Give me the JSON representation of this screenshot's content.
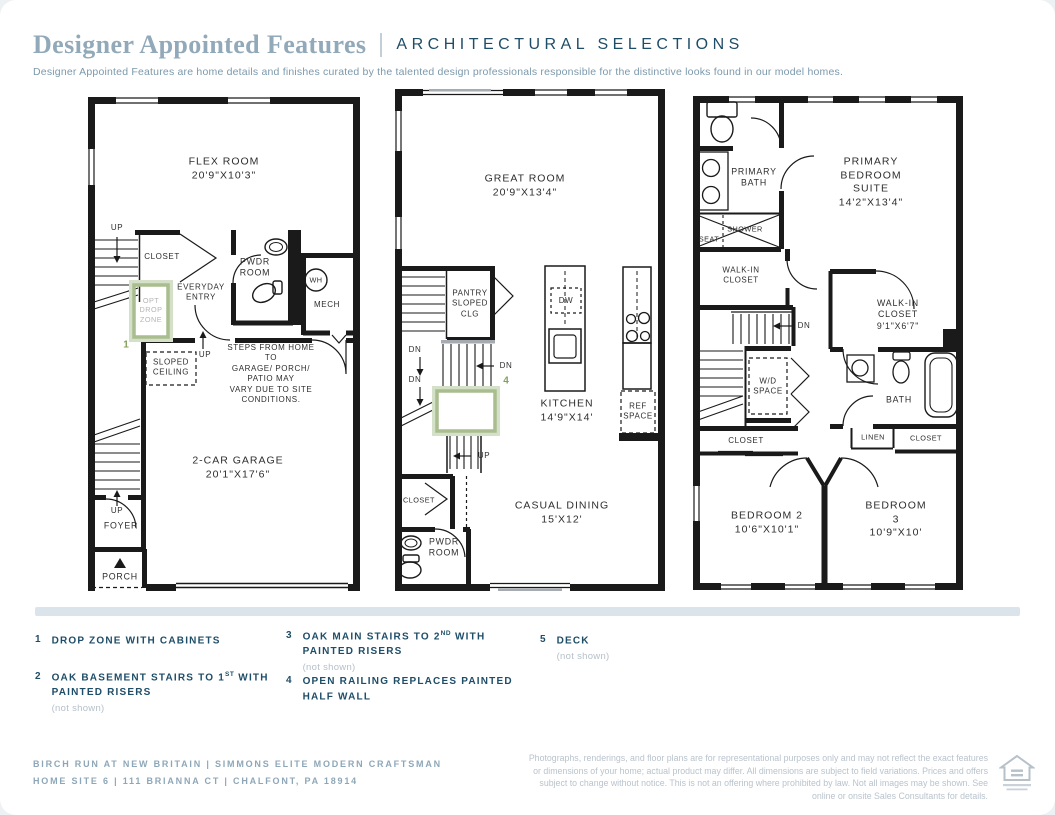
{
  "header": {
    "title": "Designer Appointed Features",
    "tag": "ARCHITECTURAL SELECTIONS",
    "description": "Designer Appointed Features are home details and finishes curated by the talented design professionals responsible for the distinctive looks found in our model homes."
  },
  "colors": {
    "navy": "#1e4d68",
    "title_blue_gray": "#92a9b9",
    "option_green": "#84a15c",
    "option_box_green": "#a9bd8f",
    "muted_gray": "#b4bfc9",
    "wall_black": "#1a1a1a"
  },
  "plans": {
    "first": {
      "name": "first-floor",
      "labels": {
        "flex_room": "FLEX ROOM\n20'9\"X10'3\"",
        "up_top": "UP",
        "closet": "CLOSET",
        "opt_drop_zone": "OPT\nDROP\nZONE",
        "marker_1": "1",
        "everyday_entry": "EVERYDAY\nENTRY",
        "pwdr_room": "PWDR\nROOM",
        "wh": "WH",
        "mech": "MECH",
        "sloped_ceiling": "SLOPED\nCEILING",
        "up_mid": "UP",
        "steps_note": "STEPS FROM HOME TO\nGARAGE/ PORCH/ PATIO MAY\nVARY DUE TO SITE CONDITIONS.",
        "garage": "2-CAR GARAGE\n20'1\"X17'6\"",
        "up_foyer": "UP",
        "foyer": "FOYER",
        "porch": "PORCH"
      }
    },
    "second": {
      "name": "second-floor",
      "labels": {
        "great_room": "GREAT ROOM\n20'9\"X13'4\"",
        "pantry": "PANTRY\nSLOPED\nCLG",
        "dw": "DW",
        "dn_a": "DN",
        "dn_b": "DN",
        "dn_c": "DN",
        "marker_4": "4",
        "kitchen": "KITCHEN\n14'9\"X14'",
        "ref_space": "REF\nSPACE",
        "up_stair": "UP",
        "closet": "CLOSET",
        "casual_dining": "CASUAL DINING\n15'X12'",
        "pwdr_room": "PWDR\nROOM"
      }
    },
    "third": {
      "name": "third-floor",
      "labels": {
        "primary_bath": "PRIMARY\nBATH",
        "primary_bedroom": "PRIMARY\nBEDROOM SUITE\n14'2\"X13'4\"",
        "seat": "SEAT",
        "shower": "SHOWER",
        "walkin_left": "WALK-IN\nCLOSET",
        "dn": "DN",
        "walkin_right": "WALK-IN\nCLOSET\n9'1\"X6'7\"",
        "wd_space": "W/D\nSPACE",
        "bath": "BATH",
        "linen": "LINEN",
        "closet_right": "CLOSET",
        "closet_left": "CLOSET",
        "bedroom2": "BEDROOM 2\n10'6\"X10'1\"",
        "bedroom3": "BEDROOM 3\n10'9\"X10'"
      }
    }
  },
  "legend": {
    "items": [
      {
        "num": "1",
        "text_a": "DROP ZONE WITH CABINETS",
        "sup": "",
        "text_b": "",
        "note": ""
      },
      {
        "num": "2",
        "text_a": "OAK BASEMENT STAIRS TO 1",
        "sup": "ST",
        "text_b": " WITH PAINTED RISERS",
        "note": "(not shown)"
      },
      {
        "num": "3",
        "text_a": "OAK MAIN STAIRS TO 2",
        "sup": "ND",
        "text_b": " WITH PAINTED RISERS",
        "note": "(not shown)"
      },
      {
        "num": "4",
        "text_a": "OPEN RAILING REPLACES PAINTED HALF WALL",
        "sup": "",
        "text_b": "",
        "note": ""
      },
      {
        "num": "5",
        "text_a": "DECK",
        "sup": "",
        "text_b": "",
        "note": "(not shown)"
      }
    ]
  },
  "footer": {
    "line1": "BIRCH RUN AT NEW BRITAIN  |  SIMMONS ELITE MODERN CRAFTSMAN",
    "line2": "HOME SITE 6  |  111 BRIANNA CT  |  CHALFONT, PA 18914",
    "disclaimer": "Photographs, renderings, and floor plans are for representational purposes only and may not reflect the exact features or dimensions of your home; actual product may differ. All dimensions are subject to field variations. Prices and offers subject to change without notice. This is not an offering where prohibited by law. Not all images may be shown. See online or onsite Sales Consultants for details.",
    "logo": "equal-housing-opportunity"
  }
}
